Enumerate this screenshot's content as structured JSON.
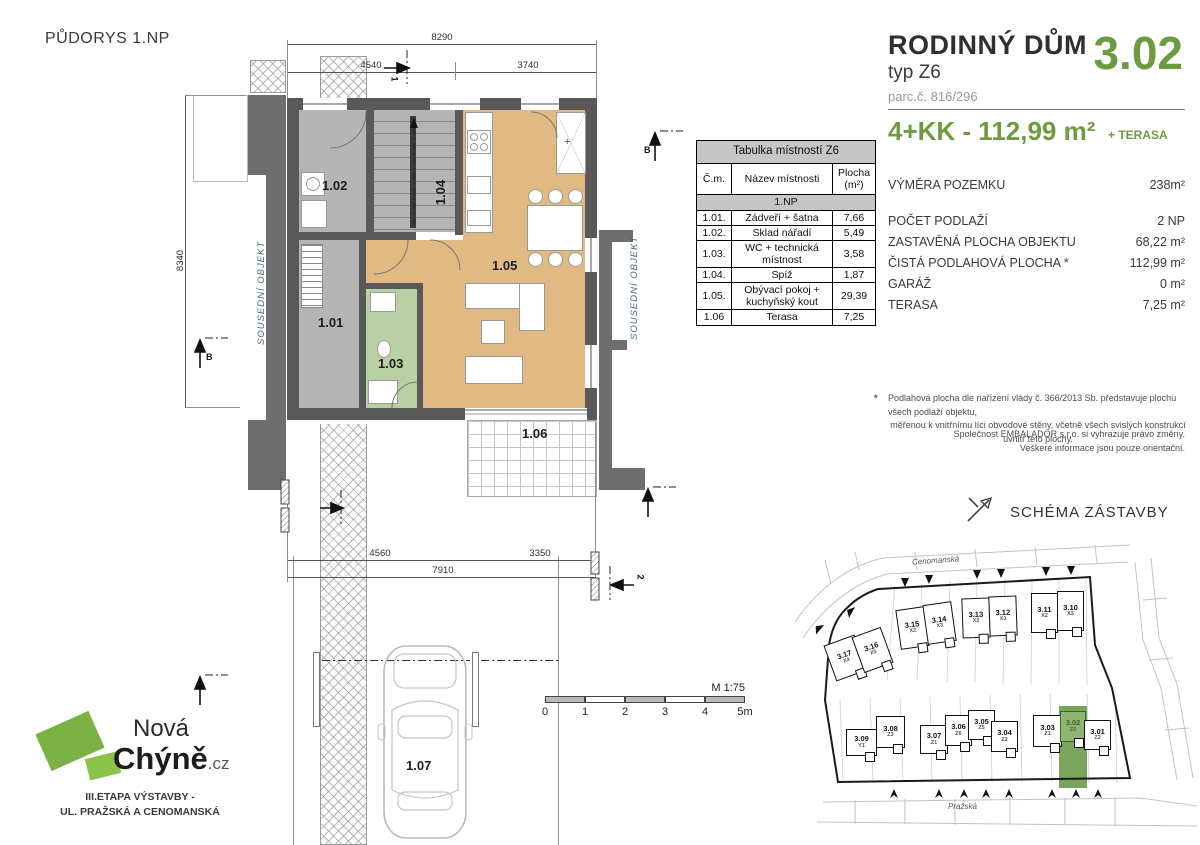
{
  "title": "PŮDORYS 1.NP",
  "header": {
    "building_type": "RODINNÝ DŮM",
    "type_label": "typ Z6",
    "parcel": "parc.č. 816/296",
    "unit_number": "3.02",
    "layout_area": "4+KK - 112,99 m²",
    "terrace_note": "+ TERASA",
    "accent_color": "#6d9c40"
  },
  "specs": {
    "rows": [
      {
        "label": "VÝMĚRA POZEMKU",
        "value": "238m²"
      },
      {
        "label": "POČET PODLAŽÍ",
        "value": "2 NP"
      },
      {
        "label": "ZASTAVĚNÁ PLOCHA OBJEKTU",
        "value": "68,22 m²"
      },
      {
        "label": "ČISTÁ PODLAHOVÁ PLOCHA  *",
        "value": "112,99 m²"
      },
      {
        "label": "GARÁŽ",
        "value": "0 m²"
      },
      {
        "label": "TERASA",
        "value": "7,25 m²"
      }
    ]
  },
  "footnote": {
    "marker": "*",
    "line1": "Podlahová plocha dle nařízení vlády č. 366/2013 Sb. představuje plochu všech podlaží objektu,",
    "line2": "měřenou k vnitřnímu líci obvodové stěny, včetně všech svislých konstrukcí uvnitř této plochy."
  },
  "disclaimer": {
    "line1": "Společnost EMBALADOR s.r.o. si vyhrazuje právo změny.",
    "line2": "Veškeré informace jsou pouze orientační."
  },
  "rooms_table": {
    "title": "Tabulka místností Z6",
    "columns": {
      "num": "Č.m.",
      "name": "Název místnosti",
      "area_l1": "Plocha",
      "area_l2": "(m²)"
    },
    "section": "1.NP",
    "rows": [
      {
        "num": "1.01.",
        "name": "Zádveří + šatna",
        "area": "7,66"
      },
      {
        "num": "1.02.",
        "name": "Sklad nářadí",
        "area": "5,49"
      },
      {
        "num": "1.03.",
        "name": "WC + technická místnost",
        "area": "3,58"
      },
      {
        "num": "1.04.",
        "name": "Spíž",
        "area": "1,87"
      },
      {
        "num": "1.05.",
        "name": "Obývací pokoj + kuchyňský kout",
        "area": "29,39"
      },
      {
        "num": "1.06",
        "name": "Terasa",
        "area": "7,25"
      }
    ]
  },
  "plan": {
    "room_labels": {
      "r101": "1.01",
      "r102": "1.02",
      "r103": "1.03",
      "r104": "1.04",
      "r105": "1.05",
      "r106": "1.06",
      "r107": "1.07"
    },
    "neighbor_left": "SOUSEDNÍ OBJEKT",
    "neighbor_right": "SOUSEDNÍ OBJEKT",
    "dims": {
      "top_total": "8290",
      "top_left": "4540",
      "top_right": "3740",
      "side_left": "8340",
      "bottom_left": "4560",
      "bottom_right": "3350",
      "bottom_total": "7910"
    },
    "markers": {
      "b_left": "B",
      "b_right": "B",
      "cut1": "1",
      "cut2": "2"
    }
  },
  "scale_bar": {
    "label": "M 1:75",
    "ticks": [
      "0",
      "1",
      "2",
      "3",
      "4",
      "5m"
    ]
  },
  "schema": {
    "title": "SCHÉMA ZÁSTAVBY",
    "streets": {
      "top": "Cenomanská",
      "bottom": "Pražská"
    },
    "highlight_color": "#7ba45c",
    "houses": [
      {
        "label": "3.17",
        "sub": "X4"
      },
      {
        "label": "3.16",
        "sub": "X5"
      },
      {
        "label": "3.15",
        "sub": "X2"
      },
      {
        "label": "3.14",
        "sub": "X3"
      },
      {
        "label": "3.13",
        "sub": "X2"
      },
      {
        "label": "3.12",
        "sub": "X3"
      },
      {
        "label": "3.11",
        "sub": "X2"
      },
      {
        "label": "3.10",
        "sub": "X3"
      },
      {
        "label": "3.09",
        "sub": "Y1"
      },
      {
        "label": "3.08",
        "sub": "Z3"
      },
      {
        "label": "3.07",
        "sub": "Z1"
      },
      {
        "label": "3.06",
        "sub": "Z6"
      },
      {
        "label": "3.05",
        "sub": "Z5"
      },
      {
        "label": "3.04",
        "sub": "Z2"
      },
      {
        "label": "3.03",
        "sub": "Z1"
      },
      {
        "label": "3.02",
        "sub": "Z6"
      },
      {
        "label": "3.01",
        "sub": "Z2"
      }
    ]
  },
  "logo": {
    "brand_line1": "Nová",
    "brand_line2": "Chýně",
    "brand_suffix": ".cz",
    "tagline_line1": "III.ETAPA VÝSTAVBY -",
    "tagline_line2": "UL. PRAŽSKÁ A CENOMANSKÁ"
  }
}
